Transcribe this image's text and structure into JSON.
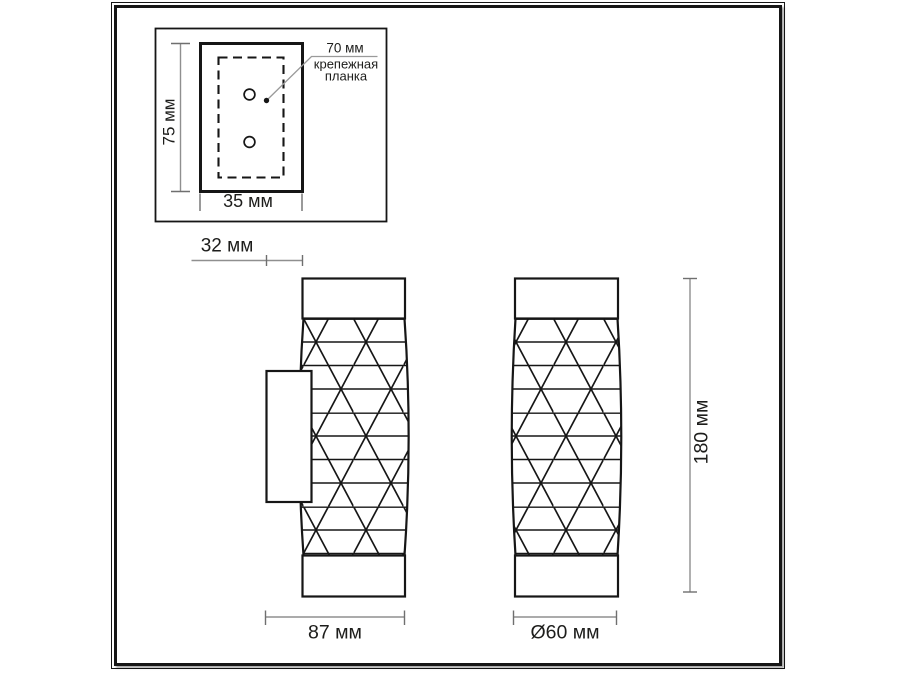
{
  "drawing": {
    "type": "wall-sconce dimension drawing",
    "inset": {
      "plate_height": "75 мм",
      "plate_width": "35 мм",
      "hole_spacing": "70 мм",
      "caption_line1": "крепежная",
      "caption_line2": "планка"
    },
    "dimensions": {
      "bracket_depth": "32 мм",
      "body_width": "87 мм",
      "body_diameter": "Ø60 мм",
      "body_height": "180 мм"
    },
    "colors": {
      "ink": "#161616",
      "dimension_line": "#8f8f8f",
      "tick": "#6f6f6f",
      "text": "#1d1d1b",
      "background": "#ffffff"
    }
  }
}
